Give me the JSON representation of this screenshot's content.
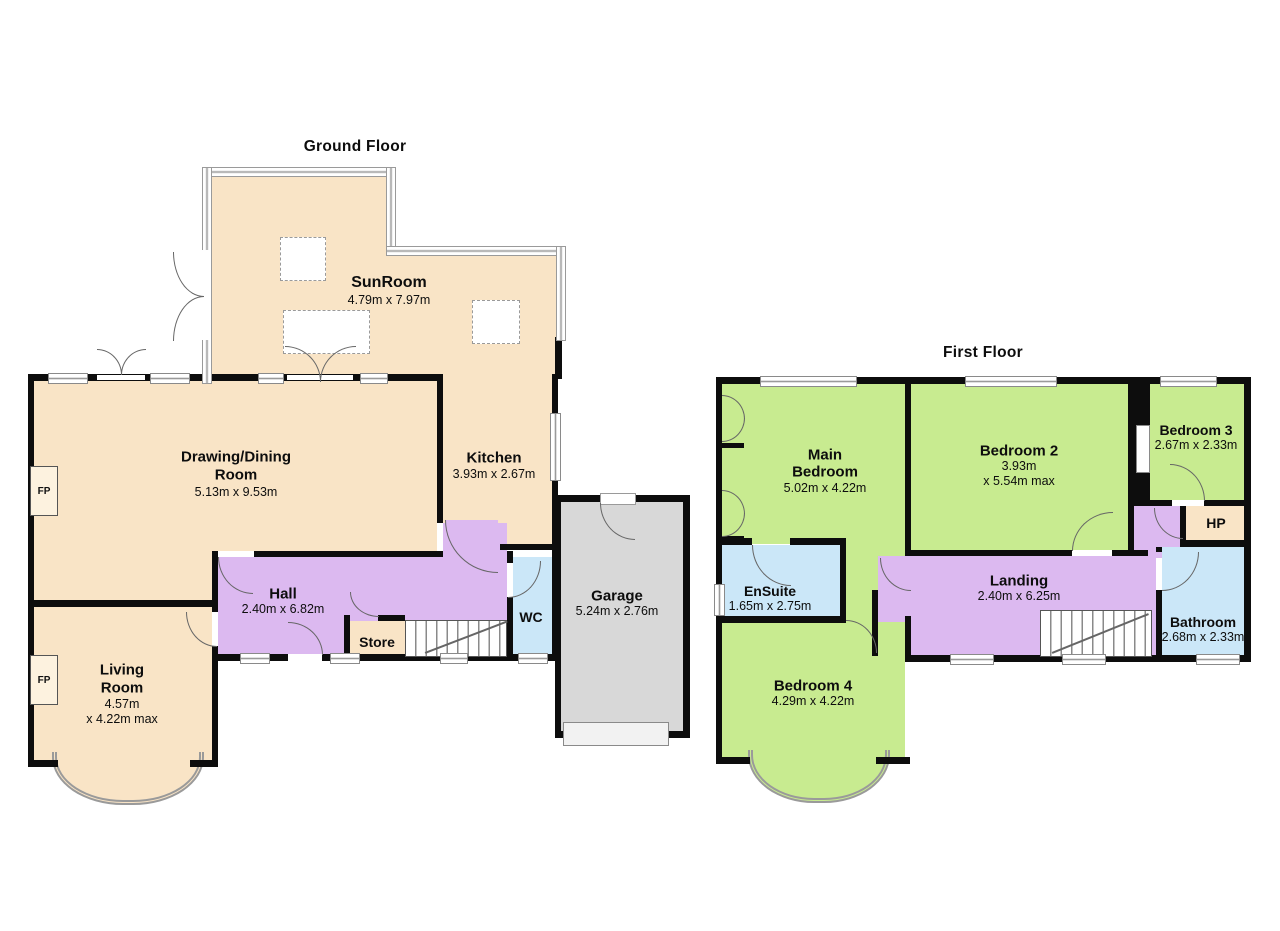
{
  "colors": {
    "cream": "#F9E4C6",
    "green": "#C8EB90",
    "purple": "#DCB9F0",
    "blue": "#CBE7F8",
    "gray": "#D8D8D8",
    "wall": "#0d0d0d"
  },
  "ground_floor": {
    "title": "Ground Floor",
    "rooms": {
      "sunroom": {
        "name": "SunRoom",
        "dims": "4.79m x 7.97m"
      },
      "drawing_dining": {
        "name1": "Drawing/Dining",
        "name2": "Room",
        "dims": "5.13m x 9.53m"
      },
      "kitchen": {
        "name": "Kitchen",
        "dims": "3.93m x 2.67m"
      },
      "hall": {
        "name": "Hall",
        "dims": "2.40m x 6.82m"
      },
      "store": {
        "name": "Store"
      },
      "wc": {
        "name": "WC"
      },
      "garage": {
        "name": "Garage",
        "dims": "5.24m x 2.76m"
      },
      "living_room": {
        "name1": "Living",
        "name2": "Room",
        "dims1": "4.57m",
        "dims2": "x 4.22m max"
      },
      "fireplace": "FP"
    }
  },
  "first_floor": {
    "title": "First Floor",
    "rooms": {
      "main_bedroom": {
        "name1": "Main",
        "name2": "Bedroom",
        "dims": "5.02m x 4.22m"
      },
      "bedroom2": {
        "name": "Bedroom 2",
        "dims1": "3.93m",
        "dims2": "x 5.54m max"
      },
      "bedroom3": {
        "name": "Bedroom 3",
        "dims": "2.67m x 2.33m"
      },
      "hp": {
        "name": "HP"
      },
      "ensuite": {
        "name": "EnSuite",
        "dims": "1.65m x 2.75m"
      },
      "landing": {
        "name": "Landing",
        "dims": "2.40m x 6.25m"
      },
      "bathroom": {
        "name": "Bathroom",
        "dims": "2.68m x 2.33m"
      },
      "bedroom4": {
        "name": "Bedroom 4",
        "dims": "4.29m x 4.22m"
      }
    }
  }
}
